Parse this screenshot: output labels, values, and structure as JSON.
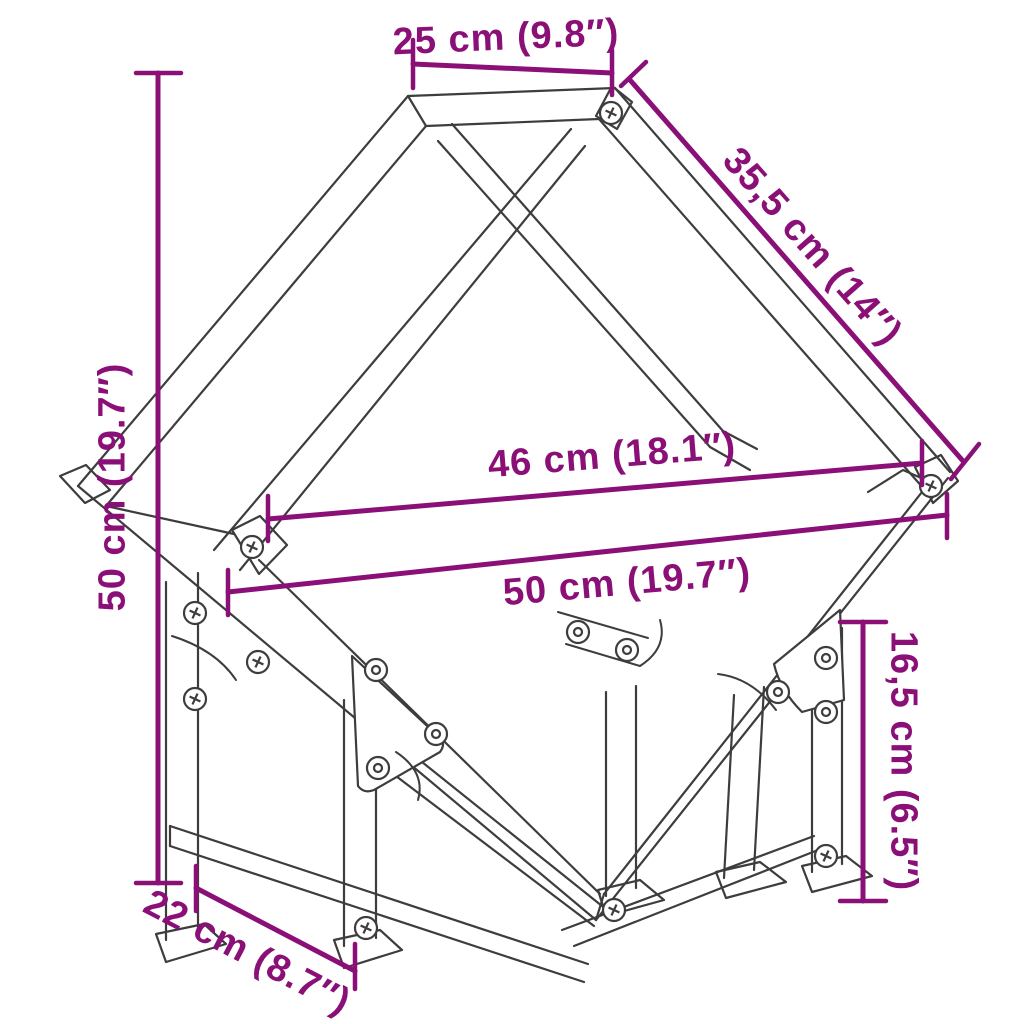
{
  "diagram": {
    "subject": "firewood-rack-dimension-drawing",
    "accent_color": "#8A1077",
    "line_color": "#3D3D3D",
    "dimensions": [
      {
        "id": "top-width",
        "label": "25 cm (9.8″)"
      },
      {
        "id": "side-depth",
        "label": "35,5 cm (14″)"
      },
      {
        "id": "total-height",
        "label": "50 cm (19.7″)"
      },
      {
        "id": "inner-width",
        "label": "46 cm (18.1″)"
      },
      {
        "id": "total-width",
        "label": "50 cm (19.7″)"
      },
      {
        "id": "foot-depth",
        "label": "22 cm (8.7″)"
      },
      {
        "id": "leg-height",
        "label": "16,5 cm (6.5″)"
      }
    ]
  }
}
